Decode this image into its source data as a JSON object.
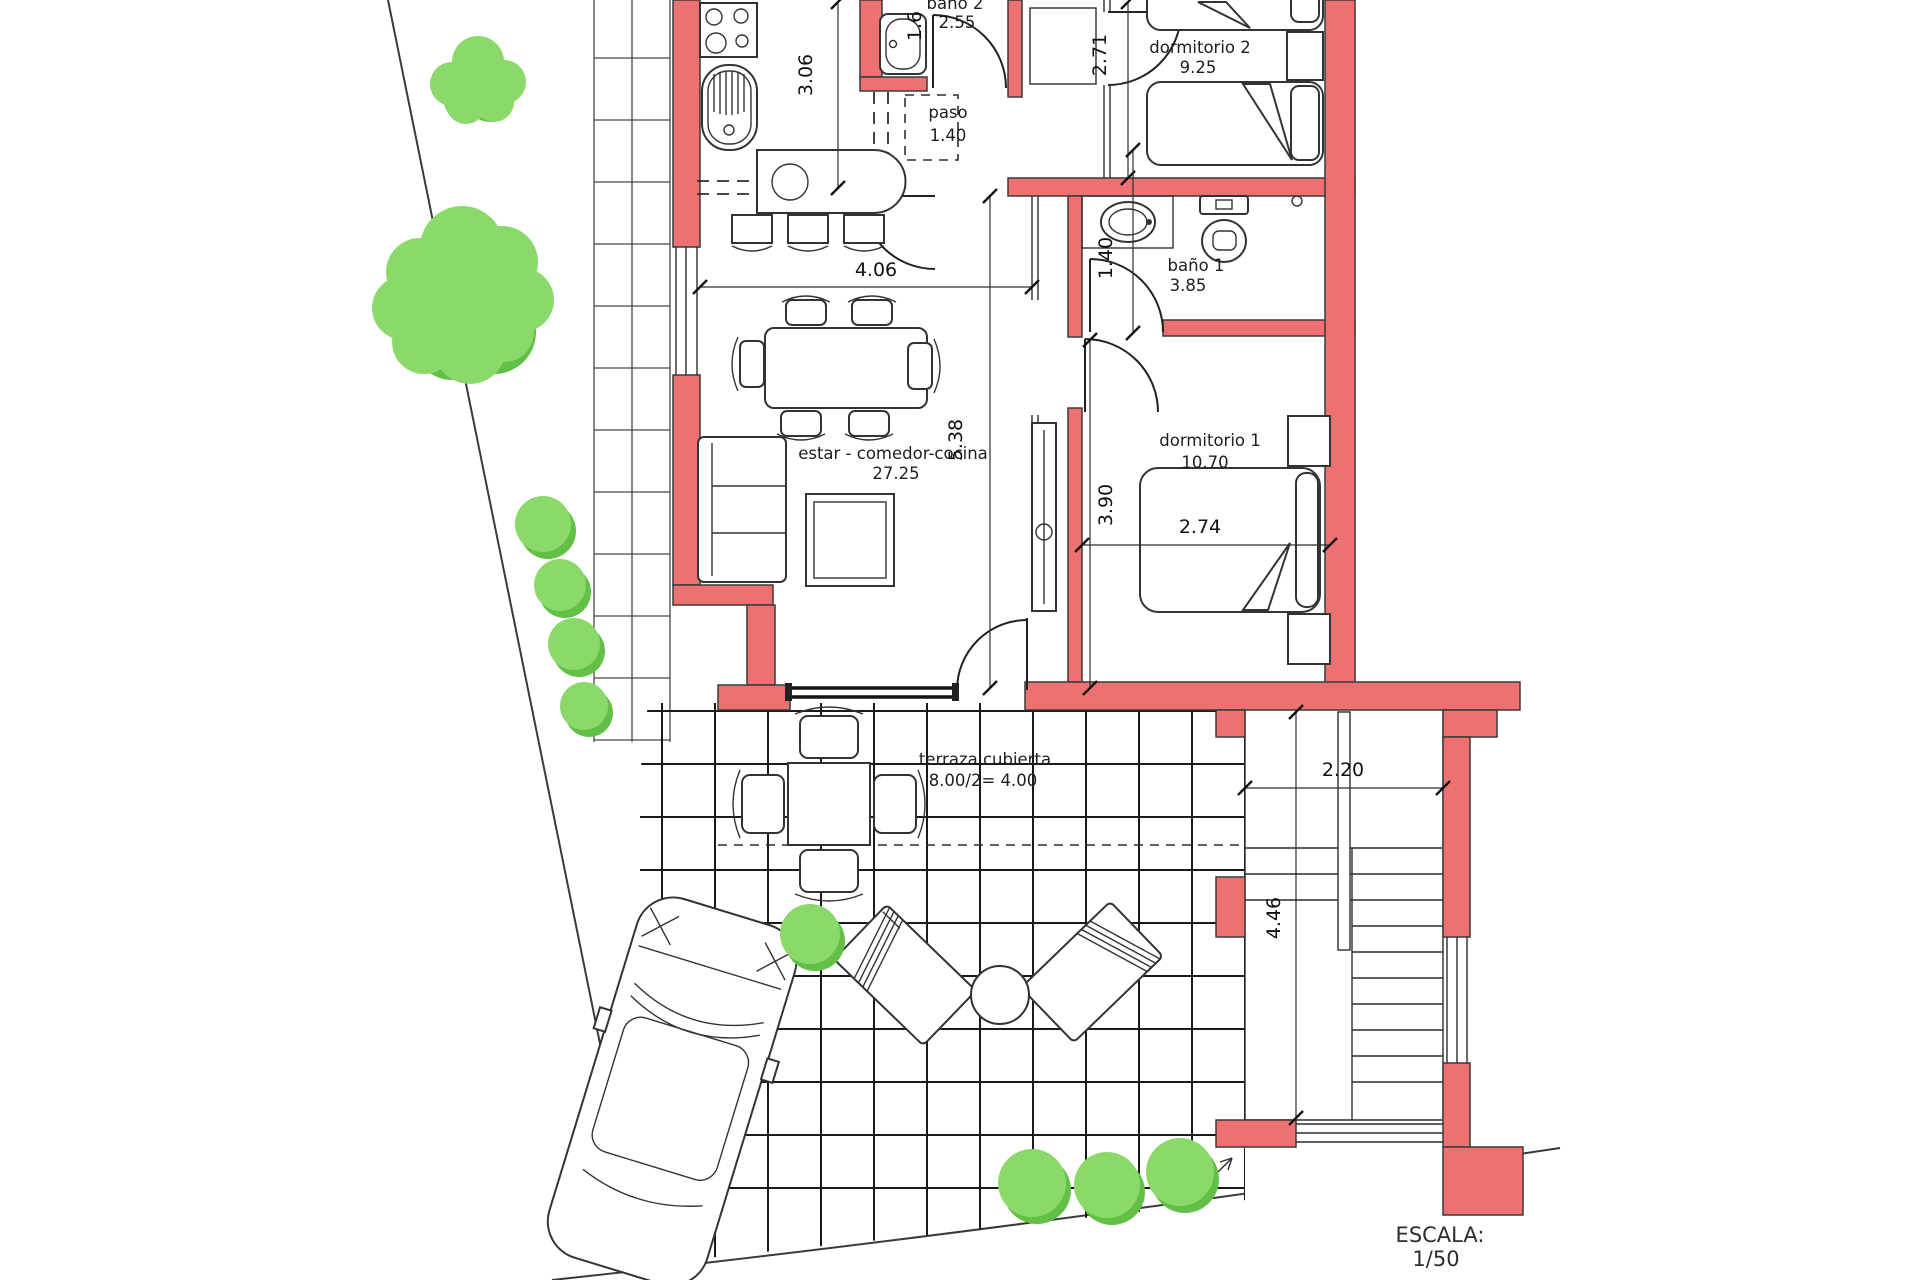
{
  "plan": {
    "rooms": {
      "bano2": {
        "name": "baño 2",
        "area": "2.55"
      },
      "paso": {
        "name": "paso",
        "area": "1.40"
      },
      "dormitorio2": {
        "name": "dormitorio 2",
        "area": "9.25"
      },
      "bano1": {
        "name": "baño 1",
        "area": "3.85"
      },
      "estar": {
        "name": "estar - comedor-cocina",
        "area": "27.25"
      },
      "dormitorio1": {
        "name": "dormitorio 1",
        "area": "10.70"
      },
      "terraza": {
        "name": "terraza cubierta",
        "area": "8.00/2= 4.00"
      }
    },
    "dimensions": {
      "kitchen_height": "3.06",
      "bath2_width": "1.6",
      "dorm2_height": "2.71",
      "living_width": "4.06",
      "hall_width": "1.40",
      "living_height": "5.38",
      "dorm1_height": "3.90",
      "dorm1_bed_width": "2.74",
      "stairs_width": "2.20",
      "stairs_height": "4.46"
    },
    "scale": {
      "label": "ESCALA:",
      "value": "1/50"
    },
    "colors": {
      "wall_fill": "#ee7172",
      "line": "#2e2e2e",
      "tree_light": "#8bd96a",
      "tree_dark": "#62c046",
      "tile_line": "#1a1a1a"
    }
  }
}
